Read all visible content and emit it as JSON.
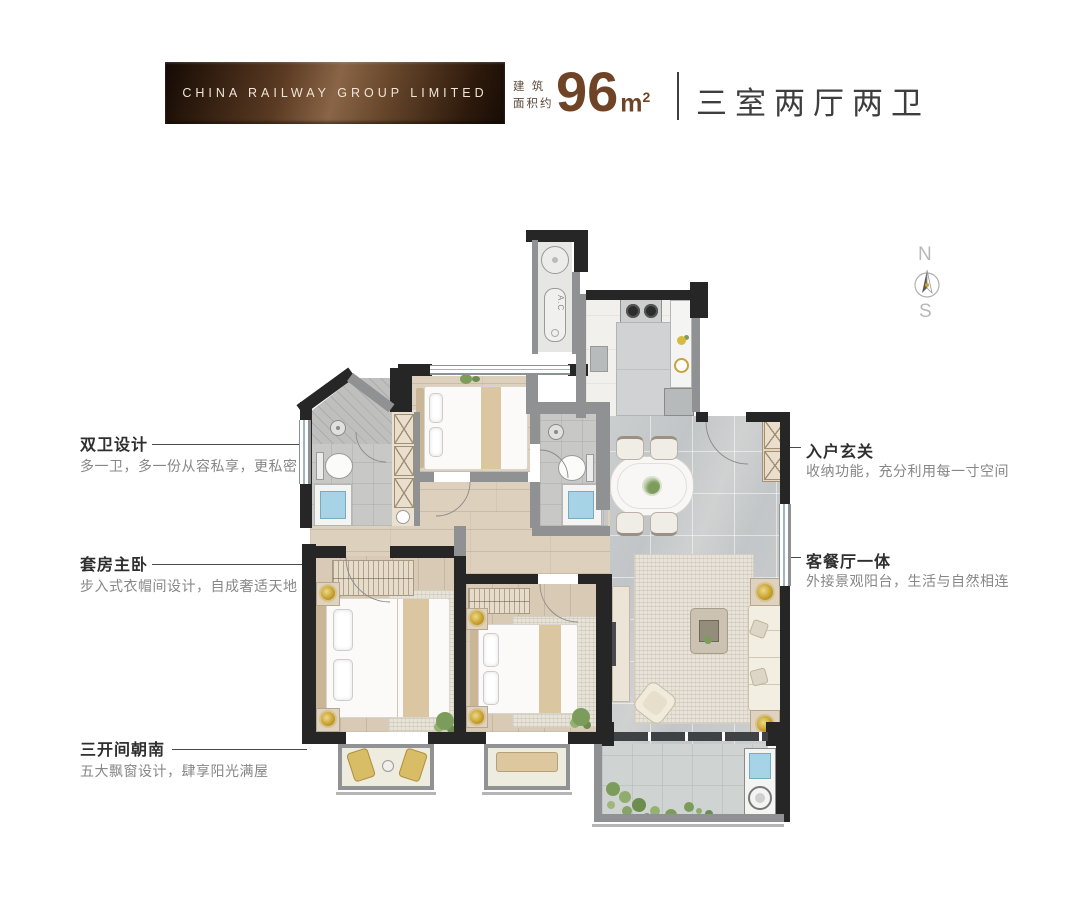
{
  "header": {
    "brand_banner": "CHINA RAILWAY GROUP LIMITED",
    "area_prefix_line1": "建 筑",
    "area_prefix_line2": "面积约",
    "area_number": "96",
    "area_unit_base": "m",
    "area_unit_sup": "2",
    "layout_name": "三室两厅两卫",
    "colors": {
      "banner_brown_dark": "#2e1b0e",
      "banner_brown_light": "#8a6547",
      "area_brown": "#6f4426",
      "title_gray": "#3e3e3e"
    }
  },
  "compass": {
    "north_label": "N",
    "south_label": "S"
  },
  "callouts": {
    "left": [
      {
        "title": "双卫设计",
        "subtitle": "多一卫，多一份从容私享，更私密"
      },
      {
        "title": "套房主卧",
        "subtitle": "步入式衣帽间设计，自成奢适天地"
      },
      {
        "title": "三开间朝南",
        "subtitle": "五大飘窗设计，肆享阳光满屋"
      }
    ],
    "right": [
      {
        "title": "入户玄关",
        "subtitle": "收纳功能，充分利用每一寸空间"
      },
      {
        "title": "客餐厅一体",
        "subtitle": "外接景观阳台，生活与自然相连"
      }
    ]
  },
  "floorplan": {
    "ac_unit_label": "A.C",
    "wall_color": "#262626",
    "secondary_wall_color": "#8f9193",
    "wood_floor_color": "#d9cab6",
    "marble_floor_color": "#c7c9ca"
  }
}
